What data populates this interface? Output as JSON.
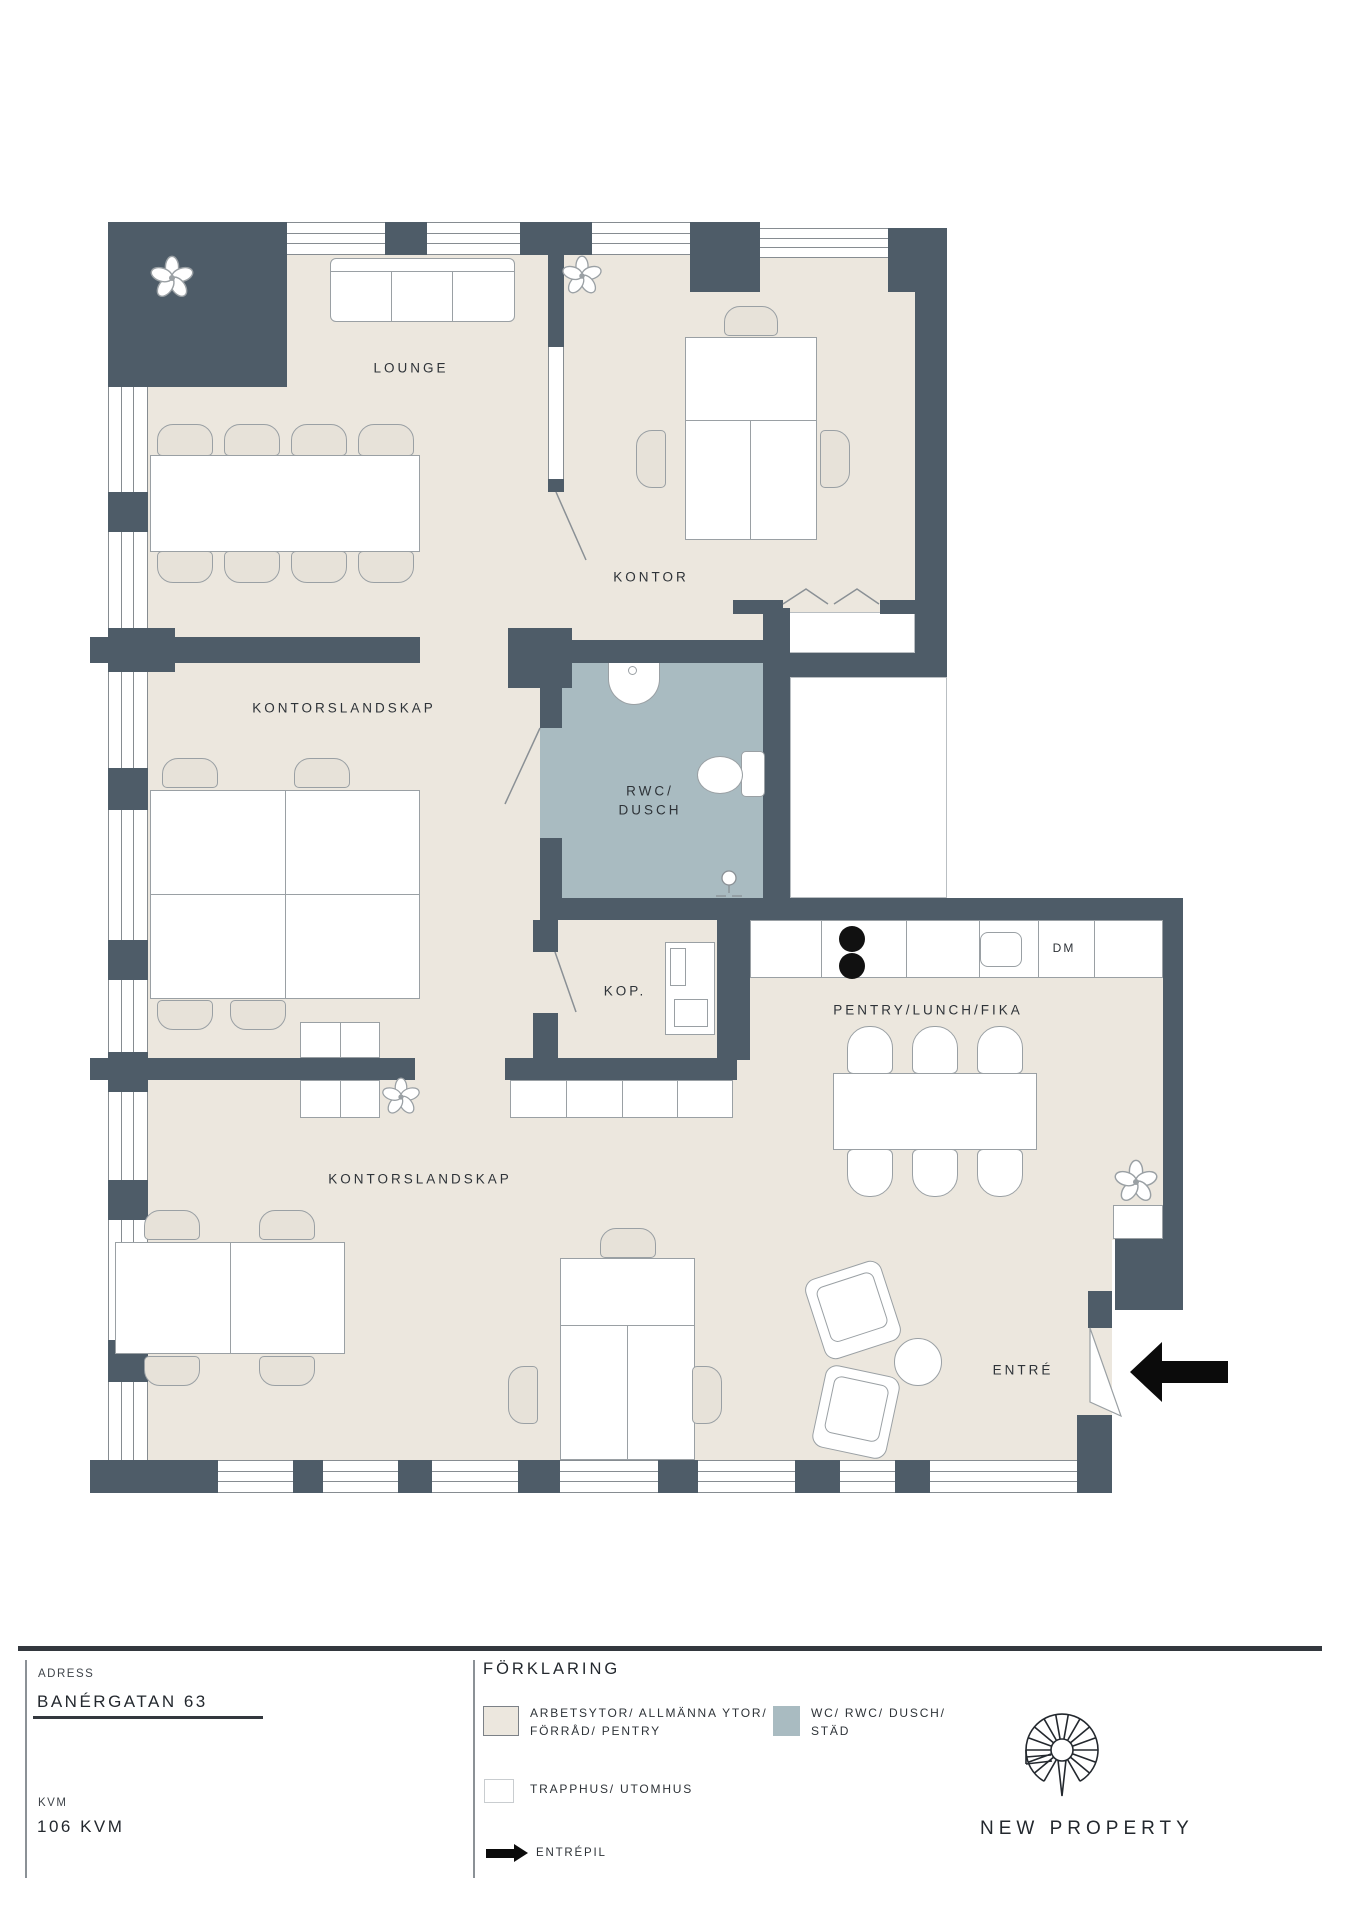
{
  "plan": {
    "rooms": {
      "lounge": "LOUNGE",
      "kontor": "KONTOR",
      "kontorslandskap_upper": "KONTORSLANDSKAP",
      "kontorslandskap_lower": "KONTORSLANDSKAP",
      "rwc_line1": "RWC/",
      "rwc_line2": "DUSCH",
      "kop": "KOP.",
      "pentry": "PENTRY/LUNCH/FIKA",
      "entre": "ENTRÉ",
      "dishwasher": "DM"
    },
    "colors": {
      "wall": "#4e5c68",
      "floor": "#ece7de",
      "wet": "#a9bbc1",
      "outline": "#9aa0a4",
      "entry_arrow": "#0b0b0b"
    }
  },
  "titleblock": {
    "adress_label": "ADRESS",
    "adress_value": "BANÉRGATAN 63",
    "kvm_label": "KVM",
    "kvm_value": "106 KVM",
    "legend_title": "FÖRKLARING",
    "legend": {
      "areas_line1": "ARBETSYTOR/ ALLMÄNNA YTOR/",
      "areas_line2": "FÖRRÅD/ PENTRY",
      "wet_line1": "WC/ RWC/ DUSCH/",
      "wet_line2": "STÄD",
      "stairs": "TRAPPHUS/ UTOMHUS",
      "entry_arrow": "ENTRÉPIL"
    },
    "brand": "NEW PROPERTY"
  }
}
